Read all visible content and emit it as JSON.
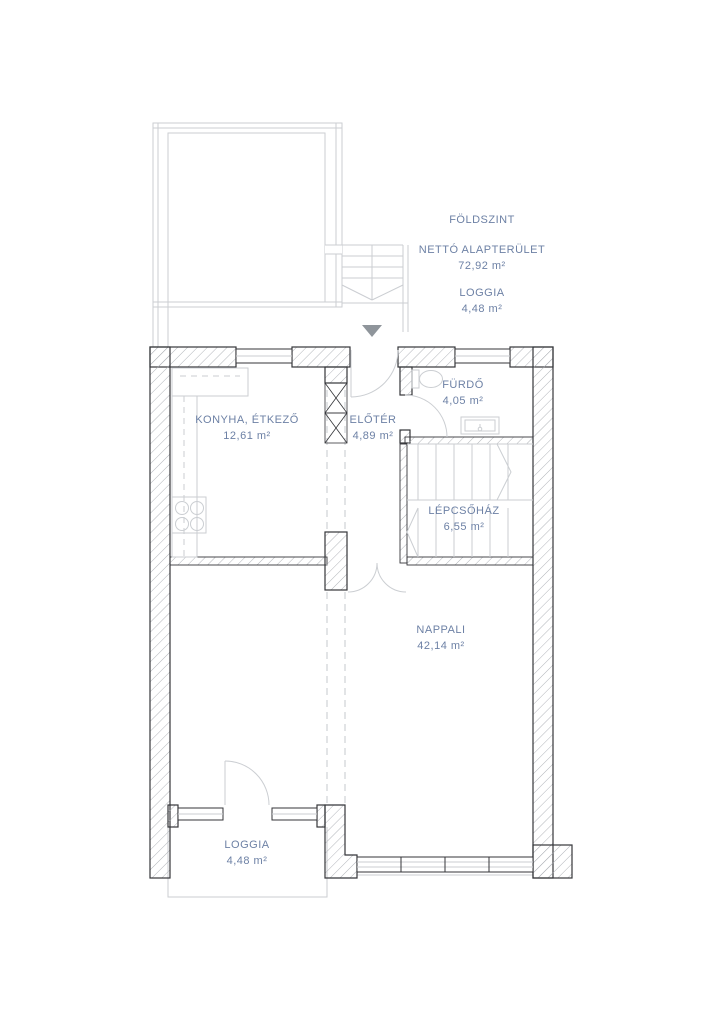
{
  "colors": {
    "label_text": "#6d81a5",
    "wall_line": "#35363a",
    "hatch_line": "#a9adb2",
    "light_line": "#cbced2",
    "arrow_fill": "#8f959b"
  },
  "info_panel": {
    "floor_title": "FÖLDSZINT",
    "net_area_label": "NETTÓ ALAPTERÜLET",
    "net_area_value": "72,92 m²",
    "loggia_label": "LOGGIA",
    "loggia_value": "4,48 m²"
  },
  "rooms": [
    {
      "id": "konyha",
      "name": "KONYHA, ÉTKEZŐ",
      "area": "12,61 m²"
    },
    {
      "id": "eloter",
      "name": "ELŐTÉR",
      "area": "4,89 m²"
    },
    {
      "id": "furdo",
      "name": "FÜRDŐ",
      "area": "4,05 m²"
    },
    {
      "id": "lepcsohaz",
      "name": "LÉPCSŐHÁZ",
      "area": "6,55 m²"
    },
    {
      "id": "nappali",
      "name": "NAPPALI",
      "area": "42,14 m²"
    },
    {
      "id": "loggia",
      "name": "LOGGIA",
      "area": "4,48 m²"
    }
  ]
}
